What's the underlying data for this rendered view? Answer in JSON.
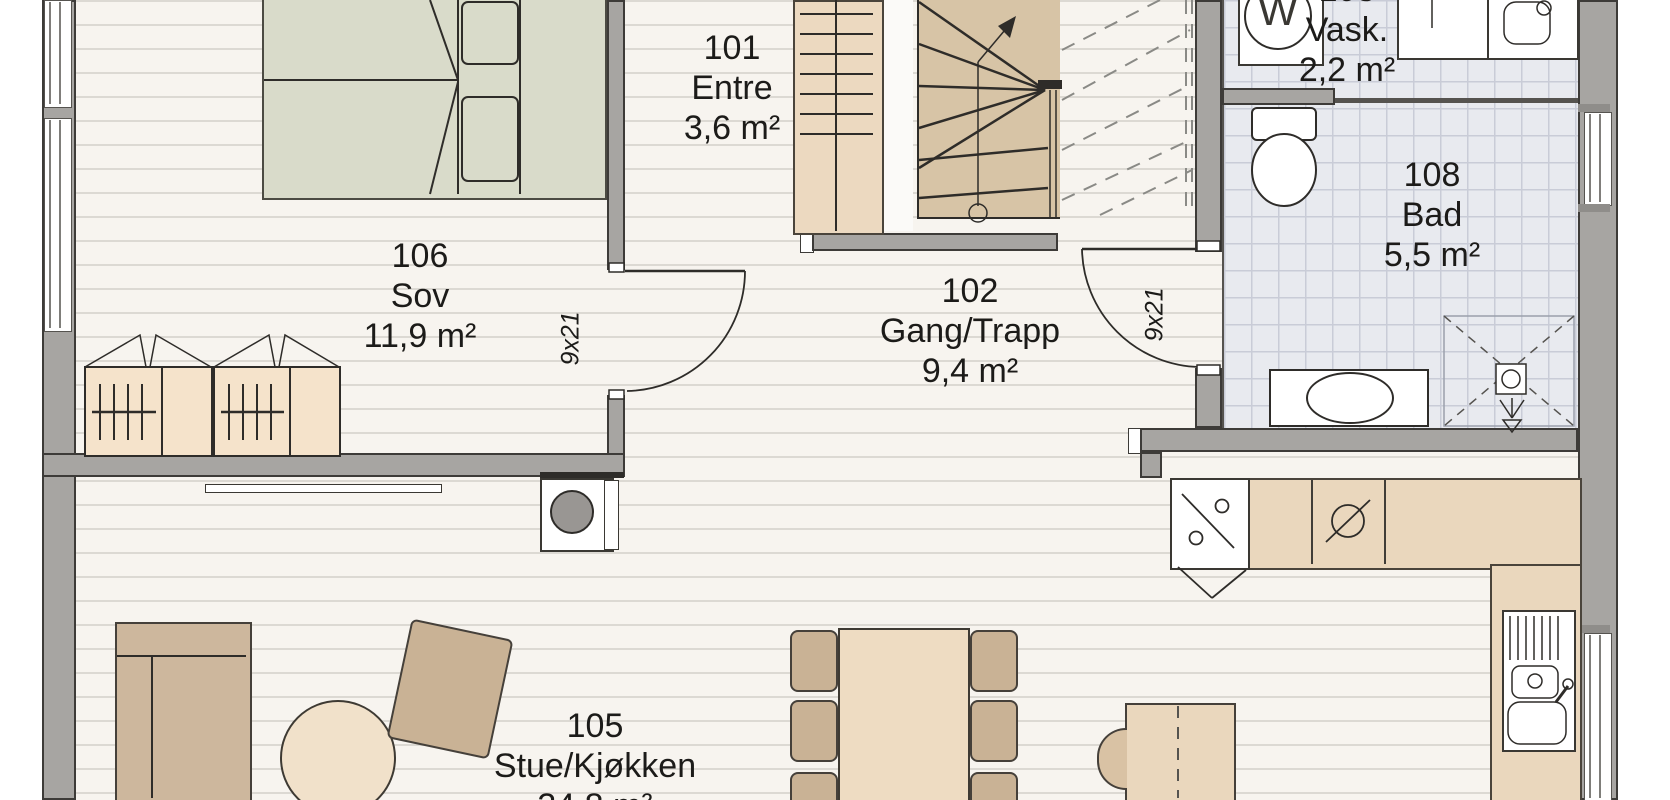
{
  "document": {
    "type": "floor-plan",
    "language": "Norwegian"
  },
  "rooms": [
    {
      "id": "101",
      "name": "Entre",
      "area": "3,6 m²"
    },
    {
      "id": "102",
      "name": "Gang/Trapp",
      "area": "9,4 m²"
    },
    {
      "id": "103",
      "name": "Vask.",
      "area": "2,2 m²"
    },
    {
      "id": "105",
      "name": "Stue/Kjøkken",
      "area": "34,8 m²"
    },
    {
      "id": "106",
      "name": "Sov",
      "area": "11,9 m²"
    },
    {
      "id": "108",
      "name": "Bad",
      "area": "5,5 m²"
    }
  ],
  "labels": {
    "door_size": "9x21",
    "washer": "W"
  },
  "colors": {
    "wall": "#a7a5a2",
    "outline": "#3d3b38",
    "wood_floor": "#f7f4ef",
    "plank_line": "#dcd9d3",
    "tile_floor": "#e8eaef",
    "tile_line": "#c9ccd7",
    "cabinet_tan": "#ead7bd",
    "furniture_tan": "#c9b295",
    "bed_sage": "#d9dbca",
    "stair_tan": "#d7c4a6",
    "fixture_white": "#ffffff"
  }
}
